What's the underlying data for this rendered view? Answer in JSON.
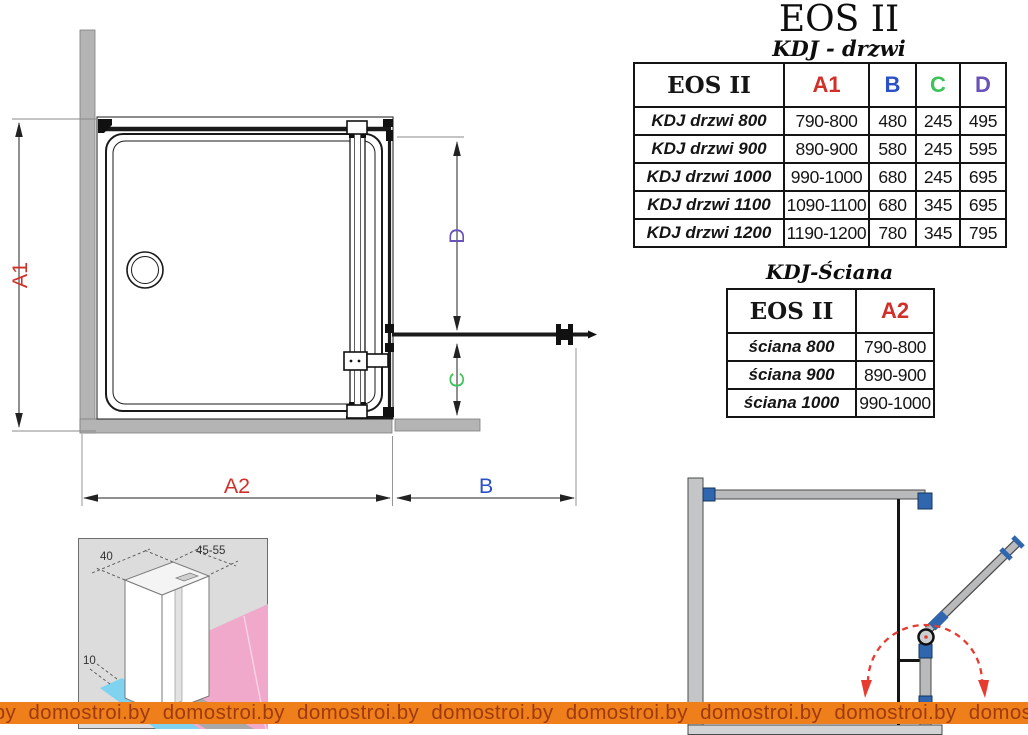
{
  "title": "EOS II",
  "tables": {
    "drzwi": {
      "subtitle": "KDJ - drzwi",
      "headers": {
        "model": "EOS II",
        "a1": "A1",
        "b": "B",
        "c": "C",
        "d": "D"
      },
      "rows": [
        {
          "label": "KDJ drzwi 800",
          "a1": "790-800",
          "b": "480",
          "c": "245",
          "d": "495"
        },
        {
          "label": "KDJ drzwi 900",
          "a1": "890-900",
          "b": "580",
          "c": "245",
          "d": "595"
        },
        {
          "label": "KDJ drzwi 1000",
          "a1": "990-1000",
          "b": "680",
          "c": "245",
          "d": "695"
        },
        {
          "label": "KDJ drzwi 1100",
          "a1": "1090-1100",
          "b": "680",
          "c": "345",
          "d": "695"
        },
        {
          "label": "KDJ drzwi 1200",
          "a1": "1190-1200",
          "b": "780",
          "c": "345",
          "d": "795"
        }
      ]
    },
    "sciana": {
      "subtitle": "KDJ-Ściana",
      "headers": {
        "model": "EOS II",
        "a2": "A2"
      },
      "rows": [
        {
          "label": "ściana 800",
          "a2": "790-800"
        },
        {
          "label": "ściana 900",
          "a2": "890-900"
        },
        {
          "label": "ściana 1000",
          "a2": "990-1000"
        }
      ]
    }
  },
  "diagram": {
    "dims": {
      "a1": "A1",
      "a2": "A2",
      "b": "B",
      "c": "C",
      "d": "D"
    },
    "colors": {
      "a": "#d03028",
      "b": "#2b51c8",
      "c": "#3ec35a",
      "d": "#6952b8"
    }
  },
  "profile_detail": {
    "width_label": "40",
    "depth_label": "45-55",
    "adjust_label": "10"
  },
  "watermark": {
    "text": "domostroi.by",
    "bg": "#ef7f1a",
    "fg": "#9e3a0e"
  }
}
